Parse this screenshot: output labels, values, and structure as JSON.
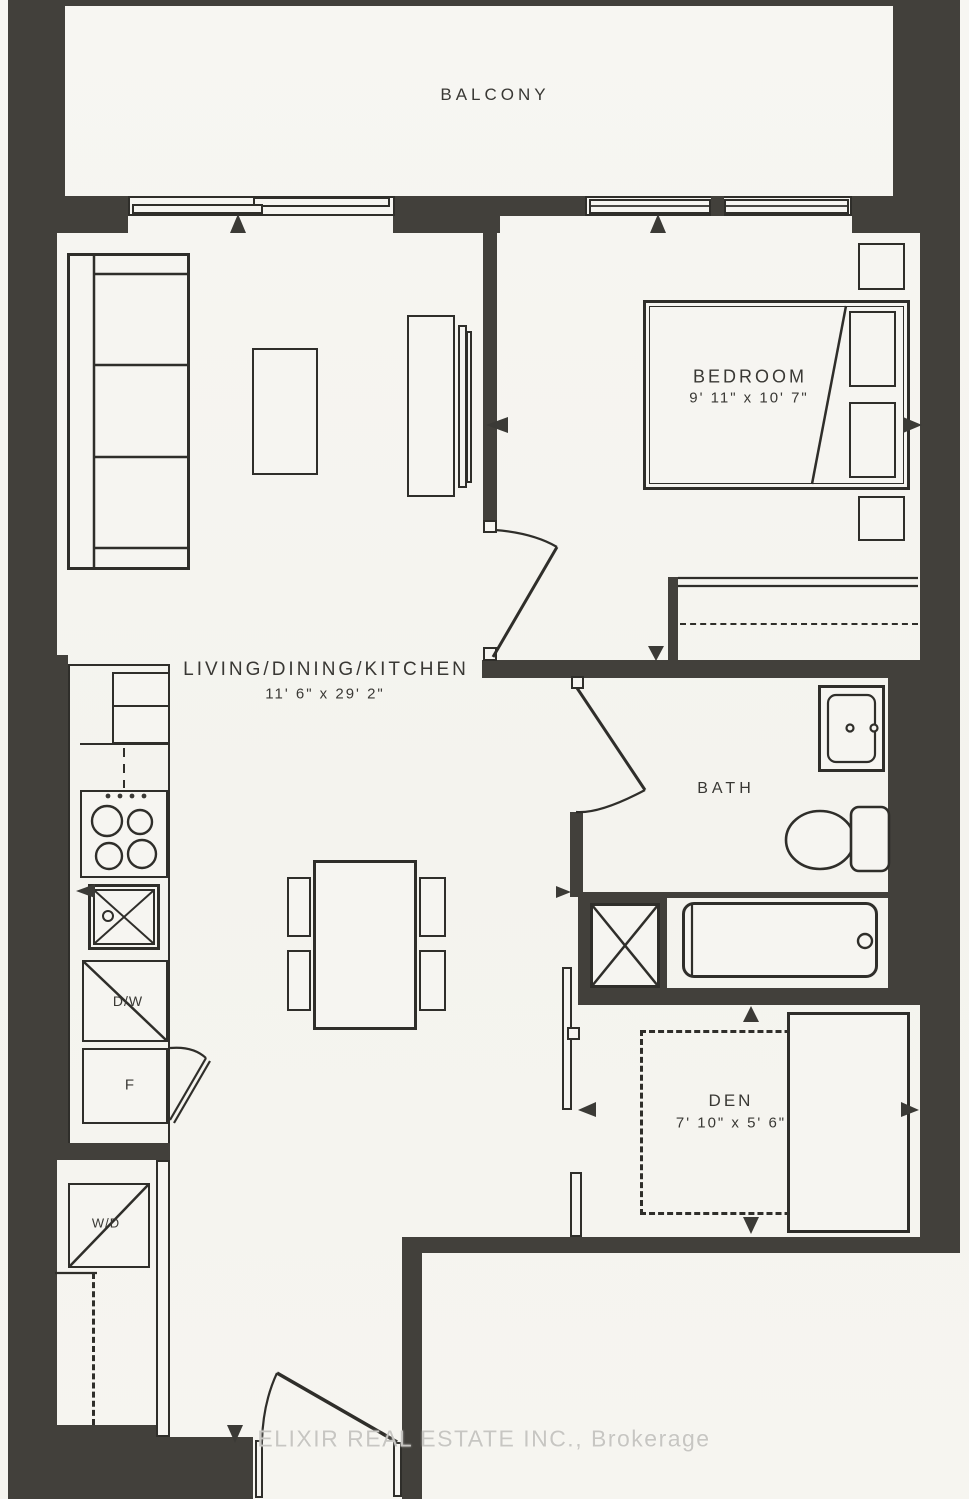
{
  "rooms": {
    "balcony": {
      "name": "BALCONY"
    },
    "bedroom": {
      "name": "BEDROOM",
      "dimensions": "9' 11\" x 10' 7\""
    },
    "living_dining_kitchen": {
      "name": "LIVING/DINING/KITCHEN",
      "dimensions": "11' 6\" x 29' 2\""
    },
    "bath": {
      "name": "BATH"
    },
    "den": {
      "name": "DEN",
      "dimensions": "7' 10\" x 5' 6\""
    }
  },
  "appliances": {
    "dishwasher": "D/W",
    "fridge": "F",
    "washer_dryer": "W/D"
  },
  "watermark": "ELIXIR REAL ESTATE INC., Brokerage",
  "colors": {
    "paper": "#f6f5f1",
    "wall": "#42403b",
    "line": "#2f2e2a",
    "text": "#393834",
    "watermark": "#c7c6c2"
  }
}
